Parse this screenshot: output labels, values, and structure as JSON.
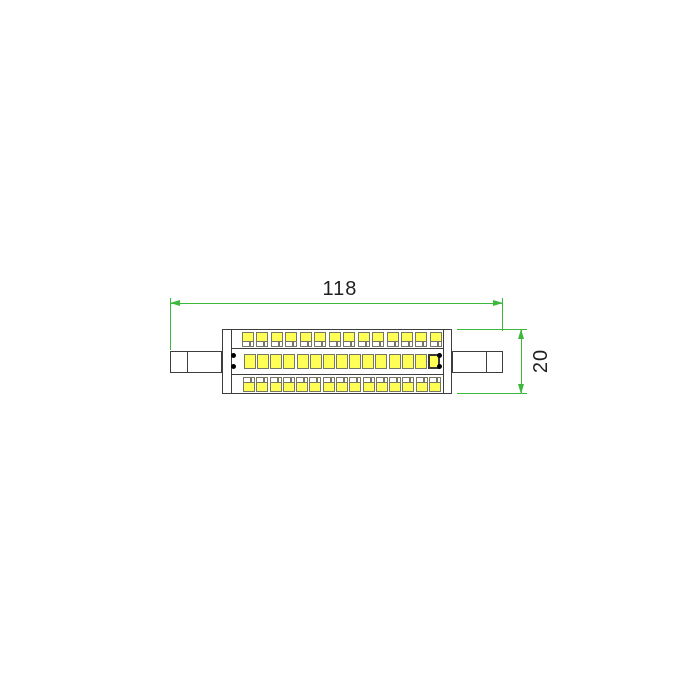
{
  "page": {
    "background": "#ffffff"
  },
  "drawing": {
    "type": "technical-dimension-drawing",
    "subject": "double-ended linear LED lamp, side view",
    "dimensions": {
      "length": {
        "value": "118",
        "orientation": "horizontal"
      },
      "diameter": {
        "value": "20",
        "orientation": "vertical"
      }
    },
    "leds": {
      "top_row_count": 14,
      "middle_row_count": 15,
      "bottom_row_count": 15,
      "alignment_dot_count": 4
    },
    "colors": {
      "dimension_line": "#3cb83c",
      "outline": "#3d3d3d",
      "chip_outline": "#767665",
      "chip_fill": "#ffff55",
      "text": "#1f1f1f",
      "dot": "#000000"
    }
  }
}
